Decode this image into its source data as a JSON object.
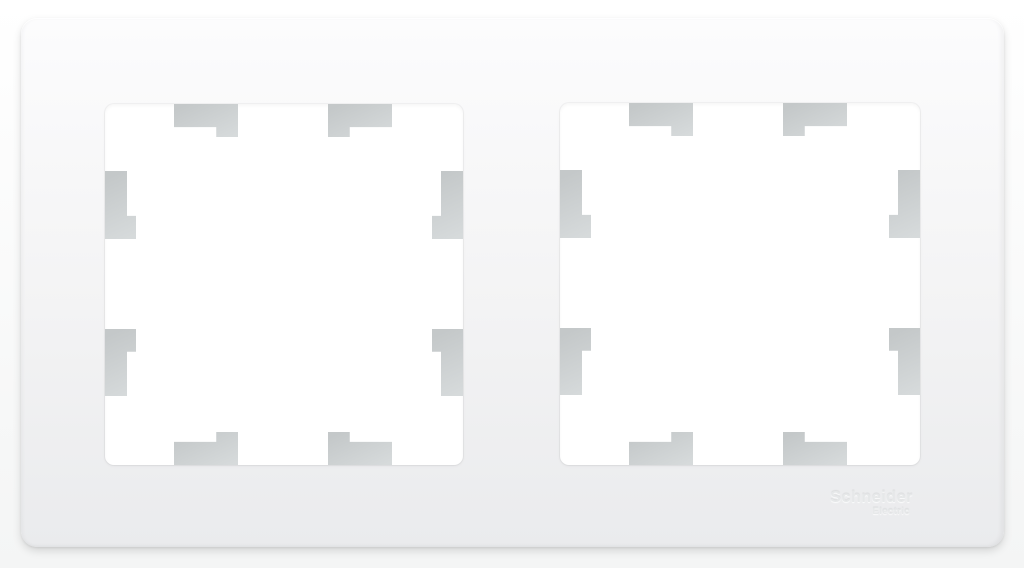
{
  "photo": {
    "description": "White two-gang (double) wall switch/socket surround frame with two square cutouts, each showing eight gray stepped mounting tabs; embossed brand logo at lower right"
  },
  "brand": {
    "name": "Schneider",
    "sub": "Electric"
  },
  "colors": {
    "page_top": "#ffffff",
    "page_bottom": "#f4f5f5",
    "frame_top": "#fcfcfd",
    "frame_mid": "#f3f3f4",
    "frame_bottom": "#eaebed",
    "tab_dark": "#c4c8c9",
    "tab_light": "#d6dadb",
    "opening_bg": "#ffffff",
    "logo_color": "#e6e8e9"
  }
}
